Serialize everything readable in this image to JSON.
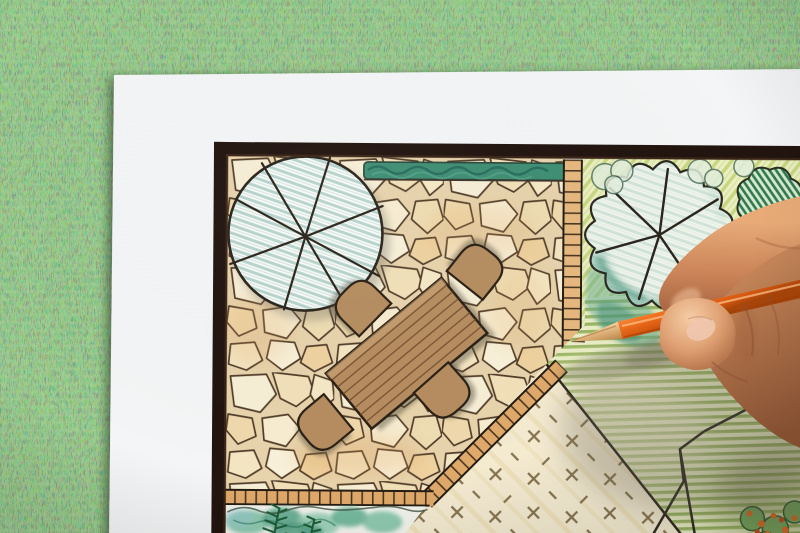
{
  "meta": {
    "title": "Hand drawing a garden landscape plan with a colored pencil",
    "description": "Photograph-style scene: a hand holding an orange colored pencil over a hand-drawn garden landscape plan on a white sheet of paper lying on green grass. The plan shows a flagstone patio with a wooden table and four chairs, round tree symbols, a hedge, tan paver paths, a striped lawn, a dashed groundcover area and a planting bed with ferns and flowers."
  },
  "scene": {
    "background": "grass-lawn",
    "paper": "white-sheet",
    "plan_elements": [
      "border-frame",
      "flagstone-patio",
      "garden-hedge",
      "shade-tree-symbol",
      "deciduous-tree-symbol",
      "dark-shrub",
      "light-shrubs",
      "paver-path-vertical",
      "paver-path-diagonal",
      "paver-path-bottom",
      "groundcover-dash-area",
      "striped-lawn",
      "lawn-edge-lines",
      "planting-bed",
      "ferns",
      "flower-cluster",
      "wooden-table",
      "chairs"
    ],
    "chair_count": 4,
    "foreground": [
      "orange-colored-pencil",
      "drawing-hand"
    ]
  },
  "colors": {
    "grass_green": "#47793f",
    "paper_white": "#f3f5f6",
    "frame_dark": "#221510",
    "stone_cream": "#f5e9cc",
    "stone_line": "#503c28",
    "wood_tan": "#b58d60",
    "outline_dark": "#2c2115",
    "hedge_teal": "#3f8e74",
    "tree_hatch_teal": "#b7d3cb",
    "garden_yellow_green": "#ebefc5",
    "lawn_stripe_green": "#a2bc6a",
    "paver_orange_tan": "#dfa96a",
    "foliage_teal": "#5fa892",
    "shrub_green": "#2e7a4c",
    "dash_brown": "#85734f",
    "pencil_orange": "#f2711f",
    "pencil_wood": "#e3b075",
    "skin_mid": "#cd8f62",
    "skin_shadow": "#95583a",
    "skin_light": "#f2c89e"
  }
}
